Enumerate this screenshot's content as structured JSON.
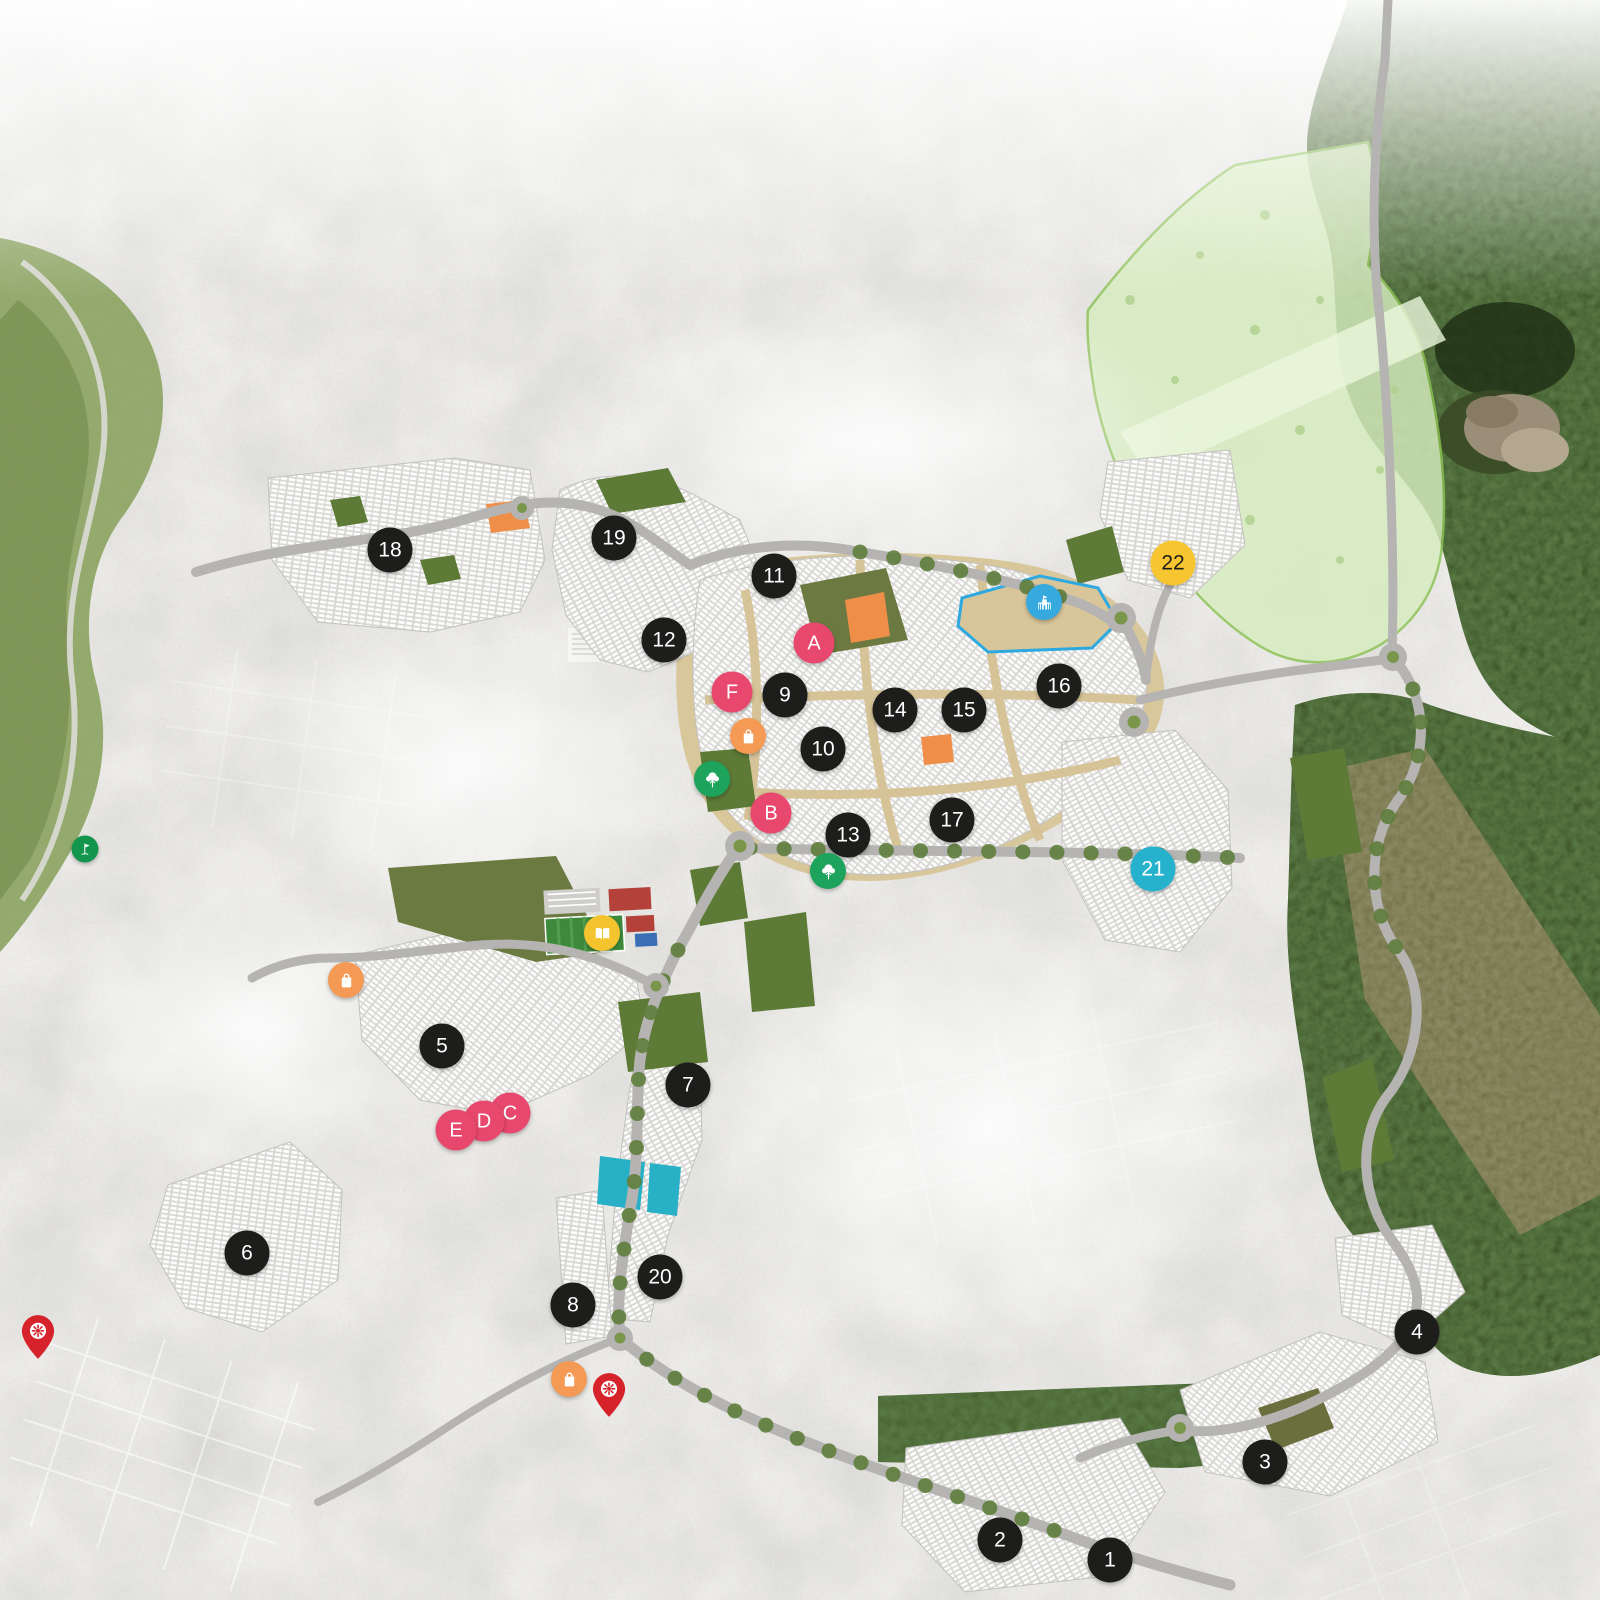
{
  "map": {
    "name": "Residential community master plan map",
    "background_color": "#eeedea",
    "palette": {
      "marker_black": "#1d1d1b",
      "marker_letter_pink": "#e8486d",
      "marker_yellow": "#f7c52f",
      "marker_yellow_text": "#1d1d1b",
      "marker_teal": "#26b2cc",
      "icon_orange": "#f49a55",
      "icon_green": "#1ea35c",
      "icon_blue": "#36aade",
      "icon_book_yellow": "#f3c42e",
      "icon_golf_green": "#13954e",
      "pin_red": "#d6232b",
      "park_green": "#5d7a37",
      "forest_green": "#40592a",
      "amenity_mint": "#d7edbf",
      "parcel_tan": "#d9c79c",
      "water_teal": "#28b0c6",
      "lot_orange": "#ef8e49",
      "school_outline_blue": "#2ea9e0",
      "road_gray": "#b5b4b2"
    },
    "markers": {
      "numbered": [
        {
          "label": "1",
          "x": 1110,
          "y": 1560
        },
        {
          "label": "2",
          "x": 1000,
          "y": 1540
        },
        {
          "label": "3",
          "x": 1265,
          "y": 1462
        },
        {
          "label": "4",
          "x": 1417,
          "y": 1332
        },
        {
          "label": "5",
          "x": 442,
          "y": 1046
        },
        {
          "label": "6",
          "x": 247,
          "y": 1253
        },
        {
          "label": "7",
          "x": 688,
          "y": 1085
        },
        {
          "label": "8",
          "x": 573,
          "y": 1305
        },
        {
          "label": "9",
          "x": 785,
          "y": 695
        },
        {
          "label": "10",
          "x": 823,
          "y": 749
        },
        {
          "label": "11",
          "x": 774,
          "y": 576
        },
        {
          "label": "12",
          "x": 664,
          "y": 640
        },
        {
          "label": "13",
          "x": 848,
          "y": 835
        },
        {
          "label": "14",
          "x": 895,
          "y": 710
        },
        {
          "label": "15",
          "x": 964,
          "y": 710
        },
        {
          "label": "16",
          "x": 1059,
          "y": 686
        },
        {
          "label": "17",
          "x": 952,
          "y": 820
        },
        {
          "label": "18",
          "x": 390,
          "y": 550
        },
        {
          "label": "19",
          "x": 614,
          "y": 538
        },
        {
          "label": "20",
          "x": 660,
          "y": 1277
        },
        {
          "label": "21",
          "x": 1153,
          "y": 869,
          "variant": "teal"
        },
        {
          "label": "22",
          "x": 1173,
          "y": 563,
          "variant": "yellow"
        }
      ],
      "lettered": [
        {
          "label": "A",
          "x": 814,
          "y": 643
        },
        {
          "label": "B",
          "x": 771,
          "y": 813
        },
        {
          "label": "C",
          "x": 510,
          "y": 1113
        },
        {
          "label": "D",
          "x": 484,
          "y": 1121
        },
        {
          "label": "E",
          "x": 456,
          "y": 1130
        },
        {
          "label": "F",
          "x": 732,
          "y": 692
        }
      ],
      "poi": [
        {
          "icon": "shopping-bag",
          "x": 346,
          "y": 980
        },
        {
          "icon": "shopping-bag",
          "x": 748,
          "y": 736
        },
        {
          "icon": "shopping-bag",
          "x": 569,
          "y": 1379
        },
        {
          "icon": "park-tree",
          "x": 712,
          "y": 779
        },
        {
          "icon": "park-tree",
          "x": 828,
          "y": 871
        },
        {
          "icon": "school",
          "x": 1044,
          "y": 602
        },
        {
          "icon": "open-book",
          "x": 602,
          "y": 933
        },
        {
          "icon": "golf-flag",
          "x": 85,
          "y": 849
        },
        {
          "icon": "location-pin",
          "x": 38,
          "y": 1355
        },
        {
          "icon": "location-pin",
          "x": 609,
          "y": 1413
        }
      ]
    }
  }
}
